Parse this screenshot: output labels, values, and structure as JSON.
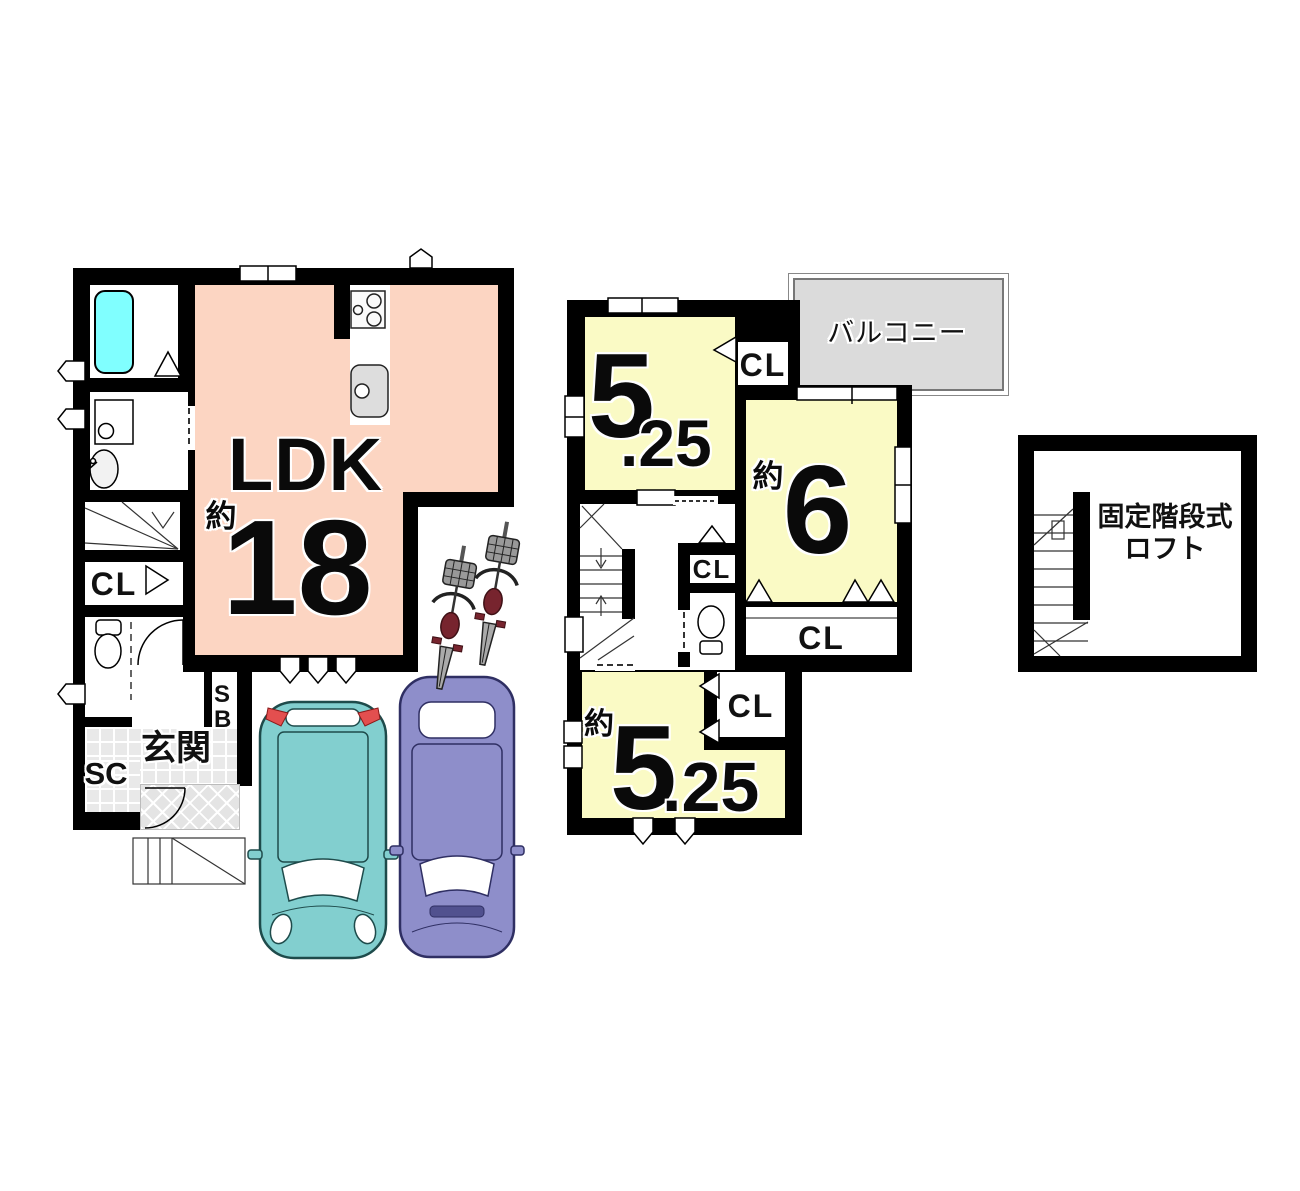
{
  "colors": {
    "wall": "#000000",
    "ldk_fill": "#FCD5C2",
    "room_fill": "#FAFAC5",
    "tub_fill": "#80FFFF",
    "balcony_fill": "#DBDBDB",
    "entrance_tile_fill": "#E9E9E9",
    "car1_fill": "#82CFCF",
    "car2_fill": "#8E8ECA",
    "bike_accent": "#77242E"
  },
  "floor1": {
    "ldk_label": "LDK",
    "ldk_approx": "約",
    "ldk_size": "18",
    "closet_label": "CL",
    "entrance_label": "玄関",
    "shoe_closet_label": "SC",
    "shoe_box_label": "SB"
  },
  "floor2": {
    "balcony_label": "バルコニー",
    "room_top": {
      "size_big": "5",
      "size_small": ".25"
    },
    "room_right": {
      "approx": "約",
      "size": "6"
    },
    "room_bottom": {
      "approx": "約",
      "size_big": "5",
      "size_small": ".25"
    },
    "closet_top_label": "CL",
    "closet_mid_label": "CL",
    "closet_band_label": "CL",
    "closet_bottom_label": "CL"
  },
  "loft": {
    "label_line1": "固定階段式",
    "label_line2": "ロフト"
  }
}
